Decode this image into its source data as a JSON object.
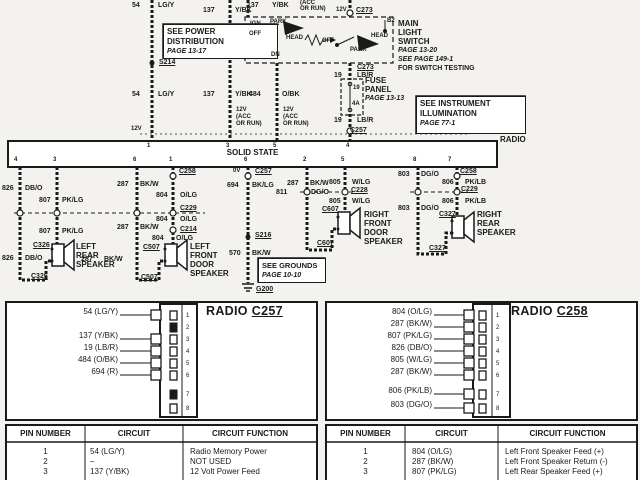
{
  "colors": {
    "ink": "#1a1a1a",
    "paper": "#f3f2ef",
    "panel": "#ffffff"
  },
  "top": {
    "w54": {
      "num": "54",
      "code": "LG/Y"
    },
    "w137": {
      "num": "137",
      "code": "Y/BK"
    },
    "w484": {
      "num": "484",
      "code": "O/BK"
    },
    "w19": {
      "num": "19",
      "code": "LB/R"
    },
    "v12": "12V",
    "acc1": "(ACC",
    "acc2": "OR RUN)",
    "power_box": {
      "l1": "SEE POWER",
      "l2": "DISTRIBUTION",
      "l3": "PAGE 13-17"
    },
    "s214": "S214",
    "c273": "C273",
    "b2": "B2",
    "sw": {
      "ign": "IGN",
      "park": "PARK",
      "off": "OFF",
      "head": "HEAD",
      "dn": "DN"
    },
    "mls": {
      "l1": "MAIN",
      "l2": "LIGHT",
      "l3": "SWITCH",
      "l4": "PAGE 13-20",
      "l5": "SEE PAGE 149-1",
      "l6": "FOR SWITCH TESTING"
    },
    "fuse": {
      "l1": "FUSE",
      "l2": "PANEL",
      "l3": "PAGE 13-13",
      "num": "19",
      "amp": "4A"
    },
    "instr": {
      "l1": "SEE  INSTRUMENT",
      "l2": "ILLUMINATION",
      "l3": "PAGE 77-1"
    },
    "c257": "C257",
    "radio": "RADIO"
  },
  "radio_box": {
    "label": "SOLID STATE",
    "top_pins": [
      "1",
      "3",
      "5",
      "4"
    ],
    "bottom_pins": [
      "4",
      "3",
      "6",
      "1",
      "6",
      "2",
      "5",
      "8",
      "7"
    ]
  },
  "mid": {
    "v0": "0V",
    "c257": "C257",
    "w694": {
      "num": "694",
      "code": "BK/LG"
    },
    "s216": "S216",
    "w570": {
      "num": "570",
      "code": "BK/W"
    },
    "g200": "G200",
    "grounds": {
      "l1": "SEE  GROUNDS",
      "l2": "PAGE 10-10"
    },
    "w826": {
      "num": "826",
      "code": "DB/O"
    },
    "w807": {
      "num": "807",
      "code": "PK/LG"
    },
    "w287": {
      "num": "287",
      "code": "BK/W"
    },
    "w804": {
      "num": "804",
      "code": "O/LG"
    },
    "w805": {
      "num": "805",
      "code": "W/LG"
    },
    "w811": {
      "num": "811",
      "code": "DG/O"
    },
    "w803": {
      "num": "803",
      "code": "DG/O"
    },
    "w806": {
      "num": "806",
      "code": "PK/LB"
    },
    "c258": "C258",
    "c229": "C229",
    "c214": "C214",
    "c228": "C228",
    "c326": "C326",
    "c507": "C507",
    "c607": "C607",
    "c327": "C327",
    "spk_lr": {
      "l1": "LEFT",
      "l2": "REAR",
      "l3": "SPEAKER"
    },
    "spk_lf": {
      "l1": "LEFT",
      "l2": "FRONT",
      "l3": "DOOR",
      "l4": "SPEAKER"
    },
    "spk_rf": {
      "l1": "RIGHT",
      "l2": "FRONT",
      "l3": "DOOR",
      "l4": "SPEAKER"
    },
    "spk_rr": {
      "l1": "RIGHT",
      "l2": "REAR",
      "l3": "SPEAKER"
    }
  },
  "conn_c257": {
    "title": "RADIO",
    "code": "C257",
    "wires": [
      "54 (LG/Y)",
      "137 (Y/BK)",
      "19 (LB/R)",
      "484 (O/BK)",
      "694 (R)"
    ],
    "pins": [
      "1",
      "2",
      "3",
      "4",
      "5",
      "6",
      "7",
      "8"
    ]
  },
  "conn_c258": {
    "title": "RADIO",
    "code": "C258",
    "wires": [
      "804 (O/LG)",
      "287 (BK/W)",
      "807 (PK/LG)",
      "826 (DB/O)",
      "805 (W/LG)",
      "287 (BK/W)",
      "806 (PK/LB)",
      "803 (DG/O)"
    ],
    "pins": [
      "1",
      "2",
      "3",
      "4",
      "5",
      "6",
      "7",
      "8"
    ]
  },
  "table_c257": {
    "headers": [
      "PIN NUMBER",
      "CIRCUIT",
      "CIRCUIT FUNCTION"
    ],
    "rows": [
      [
        "1",
        "54 (LG/Y)",
        "Radio Memory Power"
      ],
      [
        "2",
        "–",
        "NOT USED"
      ],
      [
        "3",
        "137 (Y/BK)",
        "12 Volt Power Feed"
      ]
    ]
  },
  "table_c258": {
    "headers": [
      "PIN NUMBER",
      "CIRCUIT",
      "CIRCUIT FUNCTION"
    ],
    "rows": [
      [
        "1",
        "804 (O/LG)",
        "Left Front Speaker Feed (+)"
      ],
      [
        "2",
        "287 (BK/W)",
        "Left Front Speaker Return (-)"
      ],
      [
        "3",
        "807 (PK/LG)",
        "Left Rear Speaker Feed (+)"
      ]
    ]
  }
}
